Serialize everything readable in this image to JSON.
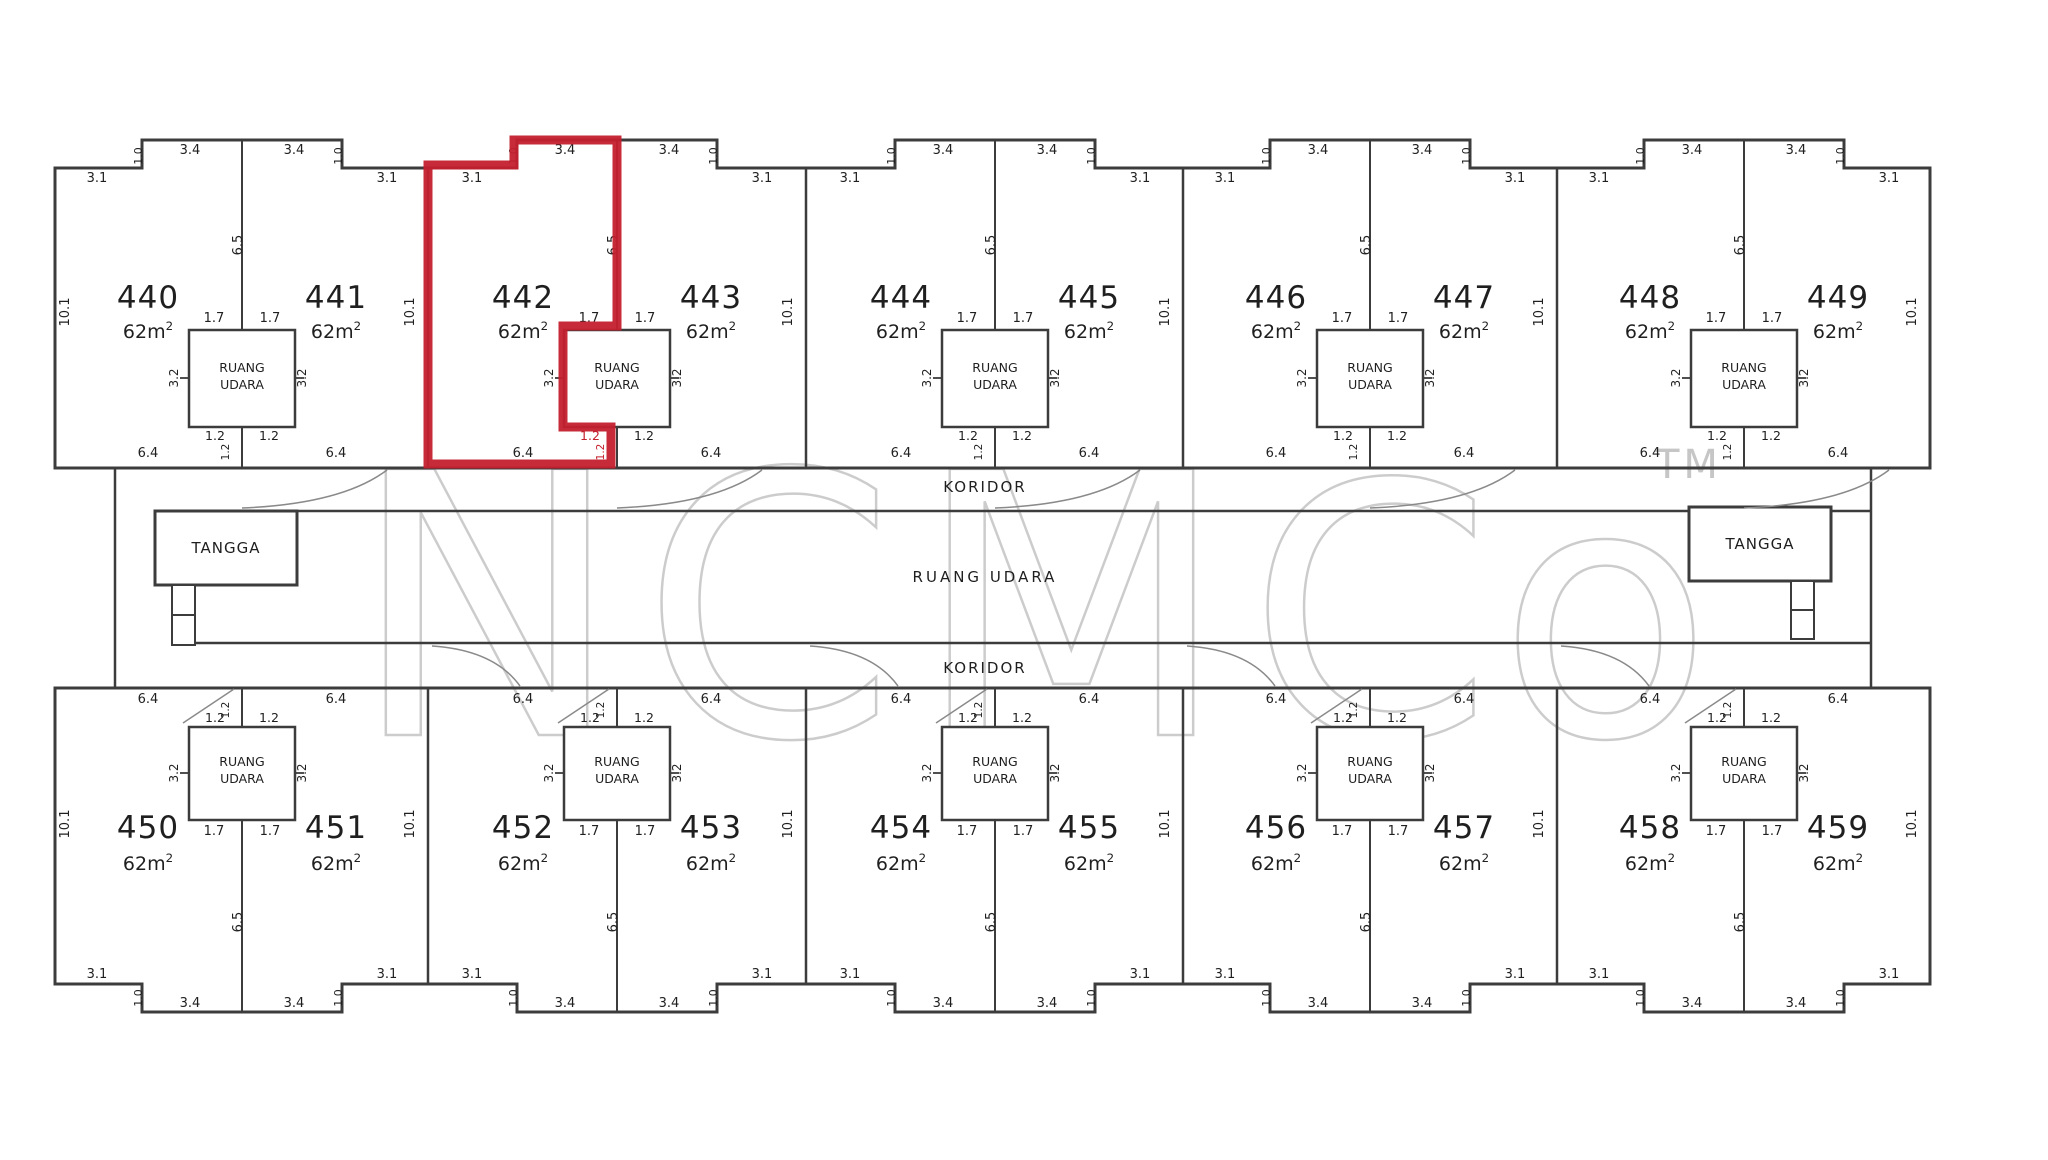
{
  "plan": {
    "koridor_top": "KORIDOR",
    "koridor_bottom": "KORIDOR",
    "ruang_udara_center": "RUANG UDARA",
    "shaft_line1": "RUANG",
    "shaft_line2": "UDARA",
    "tangga_left": "TANGGA",
    "tangga_right": "TANGGA",
    "area_label": "62m²",
    "highlighted_unit": "442",
    "units_top": [
      "440",
      "441",
      "442",
      "443",
      "444",
      "445",
      "446",
      "447",
      "448",
      "449"
    ],
    "units_bottom": [
      "450",
      "451",
      "452",
      "453",
      "454",
      "455",
      "456",
      "457",
      "458",
      "459"
    ],
    "dims": {
      "outer_flat": "3.1",
      "notch_half": "3.4",
      "notch_step": "1.0",
      "divider_height": "6.5",
      "unit_depth": "10.1",
      "shaft_top_half": "1.7",
      "shaft_side": "3.2",
      "shaft_bottom_half": "1.2",
      "unit_width_bottom": "6.4"
    },
    "watermark": {
      "left": "NCM",
      "right": "Co",
      "tm": "TM"
    }
  },
  "colors": {
    "line": "#3c3c3c",
    "label": "#1f1f1f",
    "highlight": "#c4202e",
    "watermark": "#c0c0c0",
    "background": "#ffffff"
  }
}
